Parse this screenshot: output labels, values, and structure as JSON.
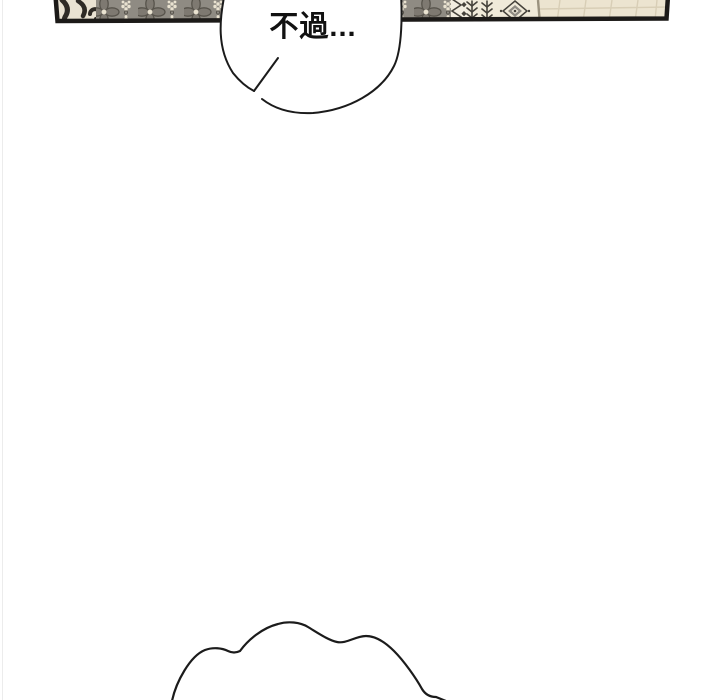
{
  "page": {
    "width": 720,
    "height": 700,
    "background": "#ffffff",
    "left_edge_line_color": "#ececec"
  },
  "panel_strip": {
    "description": "bottom sliver of comic panel: patterned rug, rug border motifs and wood floor",
    "border_color": "#1c1a18",
    "blanket_section": {
      "bg": "#e9e2d2",
      "swirl_color": "#2f2b26"
    },
    "floral_rug": {
      "bg": "#8f8b83",
      "petal_fill": "#7e7971",
      "outline": "#57534b",
      "accent_dots": "#e9e2d0"
    },
    "zigzag_border": {
      "bg": "#f2ede0",
      "motif_color": "#45423b"
    },
    "cream_border_section": {
      "bg": "#f0ead9",
      "branch_color": "#45423b",
      "diamond_outline": "#45423b",
      "diamond_ring": "#8f8b83",
      "diamond_center": "#efe9da"
    },
    "wood_floor": {
      "bg": "#ece4d0",
      "plank_line": "#d8ceb6",
      "edge_shadow": "#9a927f"
    }
  },
  "speech_bubble": {
    "text": "不過...",
    "fill": "#ffffff",
    "stroke": "#1b1b1b",
    "text_color": "#111111"
  },
  "thought_cloud": {
    "stroke": "#1b1b1b"
  }
}
